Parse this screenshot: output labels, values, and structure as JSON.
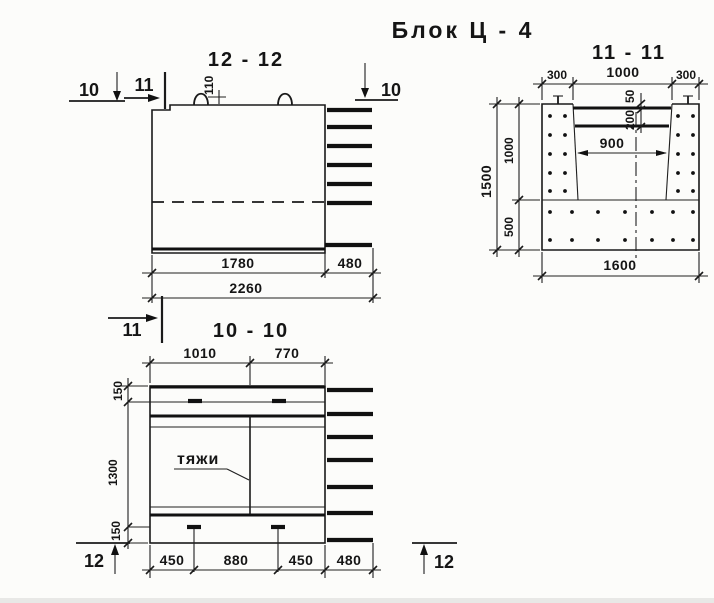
{
  "drawing": {
    "title": "Блок Ц - 4",
    "sections": {
      "s12": {
        "label": "12 - 12",
        "marker_10_left": "10",
        "marker_11_top": "11",
        "marker_10_right": "10",
        "marker_11_bottom": "11",
        "dim_110": "110",
        "dim_1780": "1780",
        "dim_480": "480",
        "dim_2260": "2260"
      },
      "s11": {
        "label": "11 - 11",
        "dim_300_left": "300",
        "dim_1000_top": "1000",
        "dim_300_right": "300",
        "dim_50": "50",
        "dim_200": "200",
        "dim_900": "900",
        "dim_1500": "1500",
        "dim_1000_side": "1000",
        "dim_500": "500",
        "dim_1600": "1600"
      },
      "s10": {
        "label": "10 - 10",
        "dim_1010": "1010",
        "dim_770": "770",
        "dim_150_top": "150",
        "dim_1300": "1300",
        "dim_150_bottom": "150",
        "annotation_ties": "тяжи",
        "dim_450_left": "450",
        "dim_880": "880",
        "dim_450_right": "450",
        "dim_480": "480",
        "marker_12_left": "12",
        "marker_12_right": "12"
      }
    }
  }
}
